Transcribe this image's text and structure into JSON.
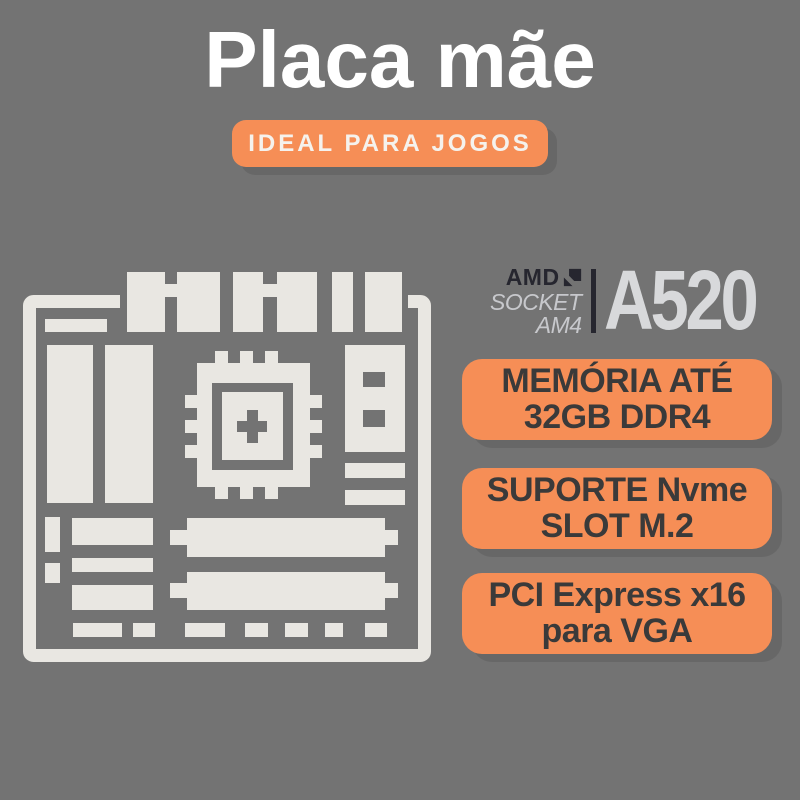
{
  "header": {
    "title": "Placa mãe",
    "tagline": "IDEAL PARA JOGOS"
  },
  "chipset": {
    "brand": "AMD",
    "socket_line1": "SOCKET",
    "socket_line2": "AM4",
    "model": "A520"
  },
  "features": [
    {
      "line1": "MEMÓRIA ATÉ",
      "line2": "32GB DDR4"
    },
    {
      "line1": "SUPORTE Nvme",
      "line2": "SLOT M.2"
    },
    {
      "line1": "PCI Express x16",
      "line2": "para VGA"
    }
  ],
  "icons": {
    "motherboard": "motherboard-icon",
    "amd_arrow": "amd-arrow-icon"
  },
  "colors": {
    "background": "#737373",
    "accent_orange": "#F68E56",
    "icon_cream": "#E9E7E2",
    "feature_text": "#3A3A3A",
    "amd_dark": "#26262F",
    "amd_socket_gray": "#C7C8CC",
    "amd_model_gray": "#D8D9DB",
    "title_white": "#FFFFFF"
  }
}
